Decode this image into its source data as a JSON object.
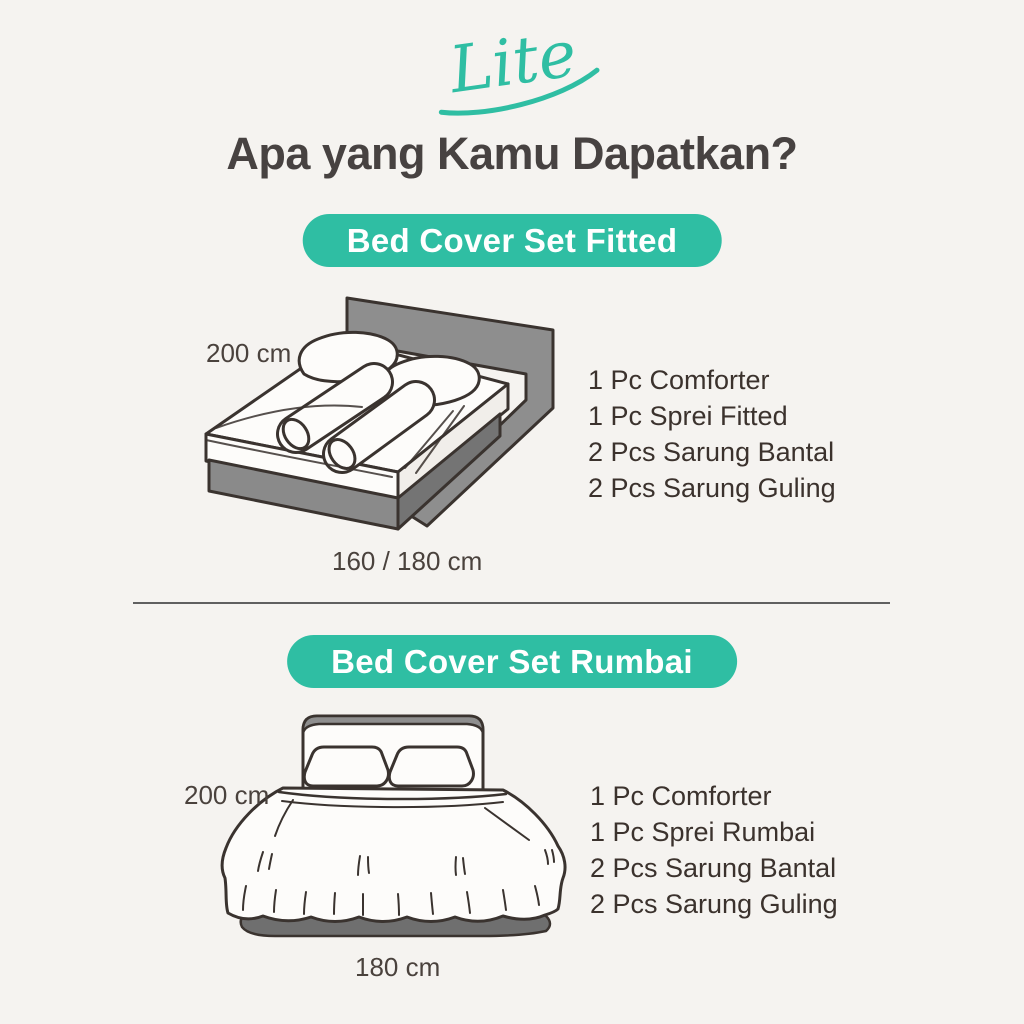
{
  "brand": {
    "logo_text": "Lite"
  },
  "heading": {
    "title": "Apa yang Kamu Dapatkan?"
  },
  "colors": {
    "accent_teal": "#2FBEA3",
    "background": "#F5F3F0",
    "heading_text": "#474241",
    "body_text": "#3B322D",
    "divider": "#606060",
    "line_art": "#3A332F",
    "illustration_gray": "#8E8E8E",
    "illustration_dark_gray": "#6F6F6F"
  },
  "sections": [
    {
      "badge": "Bed Cover Set Fitted",
      "illustration": "isometric-double-bed-with-two-pillows-and-two-bolsters",
      "dimension_height": "200 cm",
      "dimension_width": "160 / 180 cm",
      "items": [
        "1 Pc Comforter",
        "1 Pc Sprei Fitted",
        "2 Pcs Sarung Bantal",
        "2 Pcs Sarung Guling"
      ]
    },
    {
      "badge": "Bed Cover Set Rumbai",
      "illustration": "front-view-bed-with-ruffled-skirt",
      "dimension_height": "200 cm",
      "dimension_width": "180 cm",
      "items": [
        "1 Pc Comforter",
        "1 Pc Sprei Rumbai",
        "2 Pcs Sarung Bantal",
        "2 Pcs Sarung Guling"
      ]
    }
  ]
}
